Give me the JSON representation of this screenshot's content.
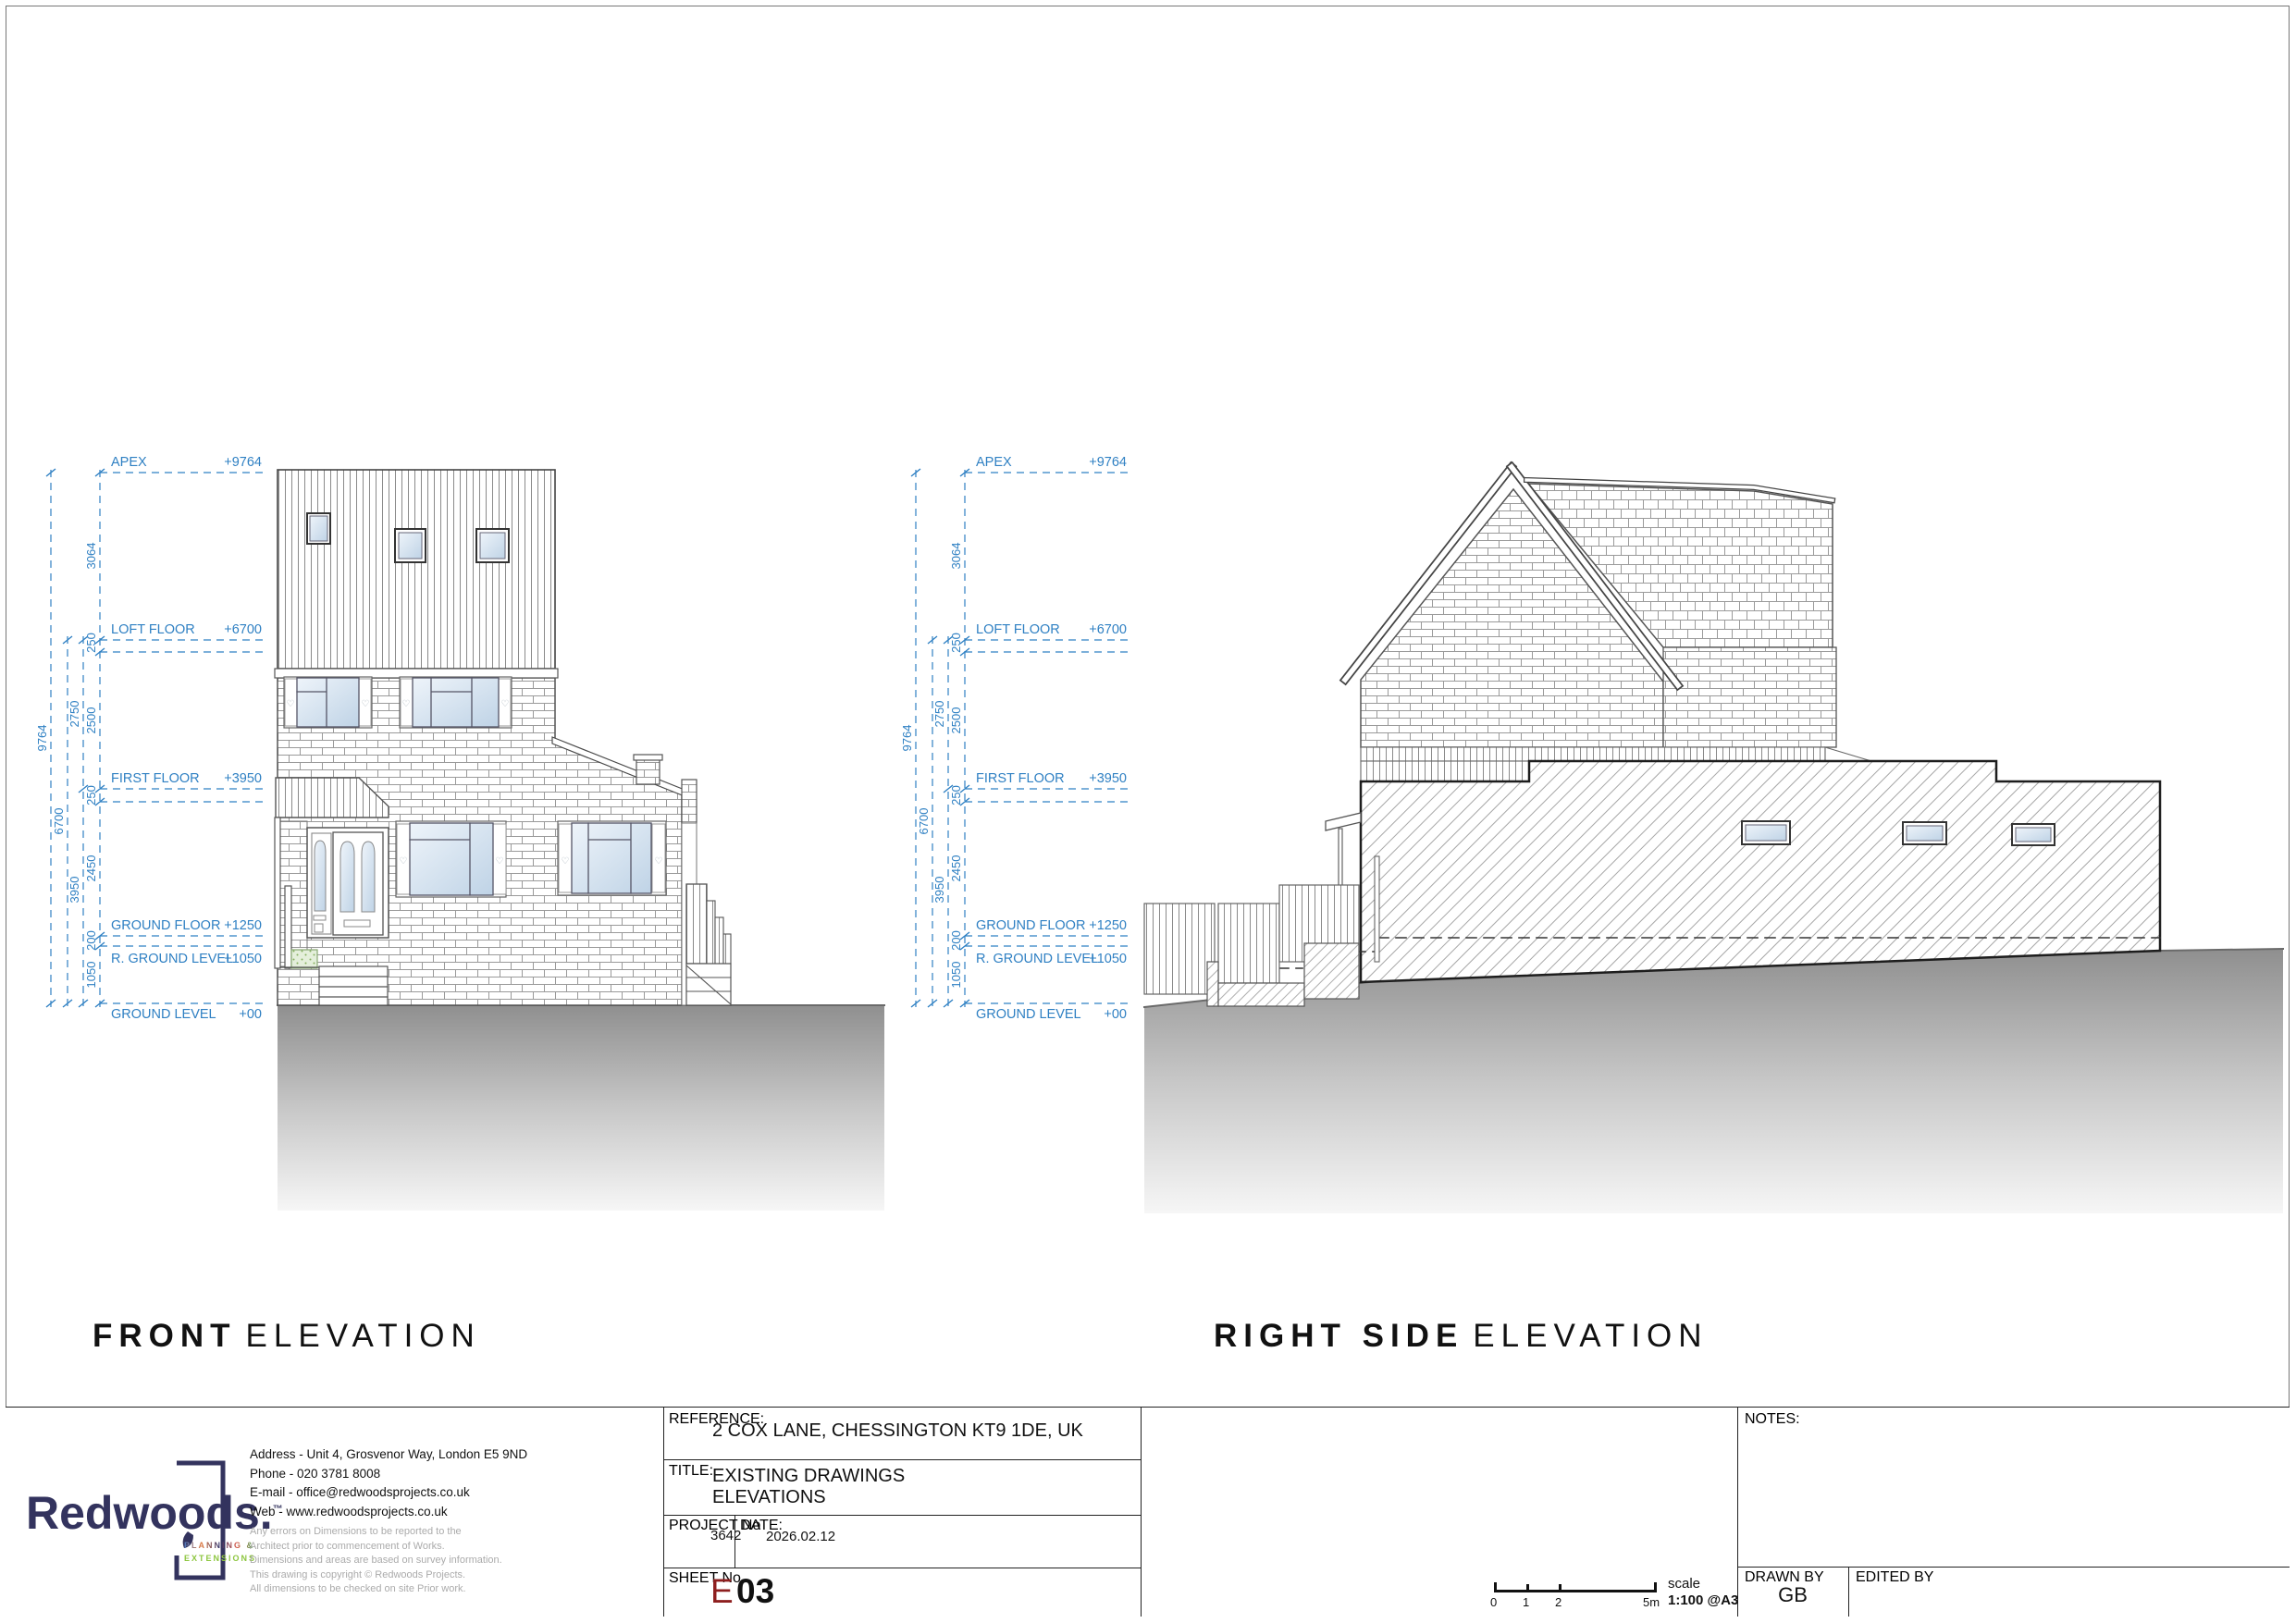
{
  "colors": {
    "dimension_blue": "#2f80c3",
    "sheet_number_red": "#8e1f1f",
    "logo_navy": "#33335e",
    "tagline_green": "#8dc63f",
    "ground_gray_top": "#8f8f8f"
  },
  "icons": {
    "shutter_heart": "♡"
  },
  "levels": [
    {
      "label": "APEX",
      "value": "+9764"
    },
    {
      "label": "LOFT FLOOR",
      "value": "+6700"
    },
    {
      "label": "FIRST FLOOR",
      "value": "+3950"
    },
    {
      "label": "GROUND FLOOR",
      "value": "+1250"
    },
    {
      "label": "R. GROUND LEVEL",
      "value": "+1050"
    },
    {
      "label": "GROUND LEVEL",
      "value": "+00"
    }
  ],
  "dims": {
    "overall": "9764",
    "ground_to_loft": "6700",
    "first_to_loft": "2750",
    "ground_to_first": "3950",
    "loft_to_apex": "3064",
    "floor_slab": "250",
    "first_storey": "2500",
    "ground_storey": "2450",
    "floor_step": "200",
    "raised_ground": "1050"
  },
  "elevation_titles": {
    "front": {
      "strong": "FRONT",
      "light": "ELEVATION"
    },
    "right_side": {
      "strong": "RIGHT SIDE",
      "light": "ELEVATION"
    }
  },
  "title_block": {
    "logo": {
      "wordmark": "Redwoods.",
      "trademark": "™",
      "tagline_line1": "PLANNING &",
      "tagline_line2": "EXTENSIONS"
    },
    "contact_lines": [
      "Address - Unit 4, Grosvenor Way, London E5 9ND",
      "Phone - 020 3781 8008",
      "E-mail - office@redwoodsprojects.co.uk",
      "Web - www.redwoodsprojects.co.uk"
    ],
    "disclaimer_lines": [
      "Any errors on Dimensions to be reported to the",
      "Architect prior to commencement of Works.",
      "Dimensions and areas are based on survey information.",
      "This drawing is copyright © Redwoods Projects.",
      "All dimensions to be checked on site Prior work."
    ],
    "reference": {
      "label": "REFERENCE:",
      "value": "2 COX LANE, CHESSINGTON KT9 1DE, UK"
    },
    "title": {
      "label": "TITLE:",
      "line1": "EXISTING DRAWINGS",
      "line2": "ELEVATIONS"
    },
    "project": {
      "label": "PROJECT No",
      "value": "3642"
    },
    "date": {
      "label": "DATE:",
      "value": "2026.02.12"
    },
    "sheet": {
      "label": "SHEET No",
      "prefix": "E",
      "number": "03"
    },
    "scale": {
      "label": "scale",
      "value": "1:100 @A3",
      "ticks": [
        "0",
        "1",
        "2",
        "5m"
      ]
    },
    "notes": {
      "label": "NOTES:"
    },
    "drawn_by": {
      "label": "DRAWN BY",
      "value": "GB"
    },
    "edited_by": {
      "label": "EDITED BY",
      "value": ""
    }
  }
}
